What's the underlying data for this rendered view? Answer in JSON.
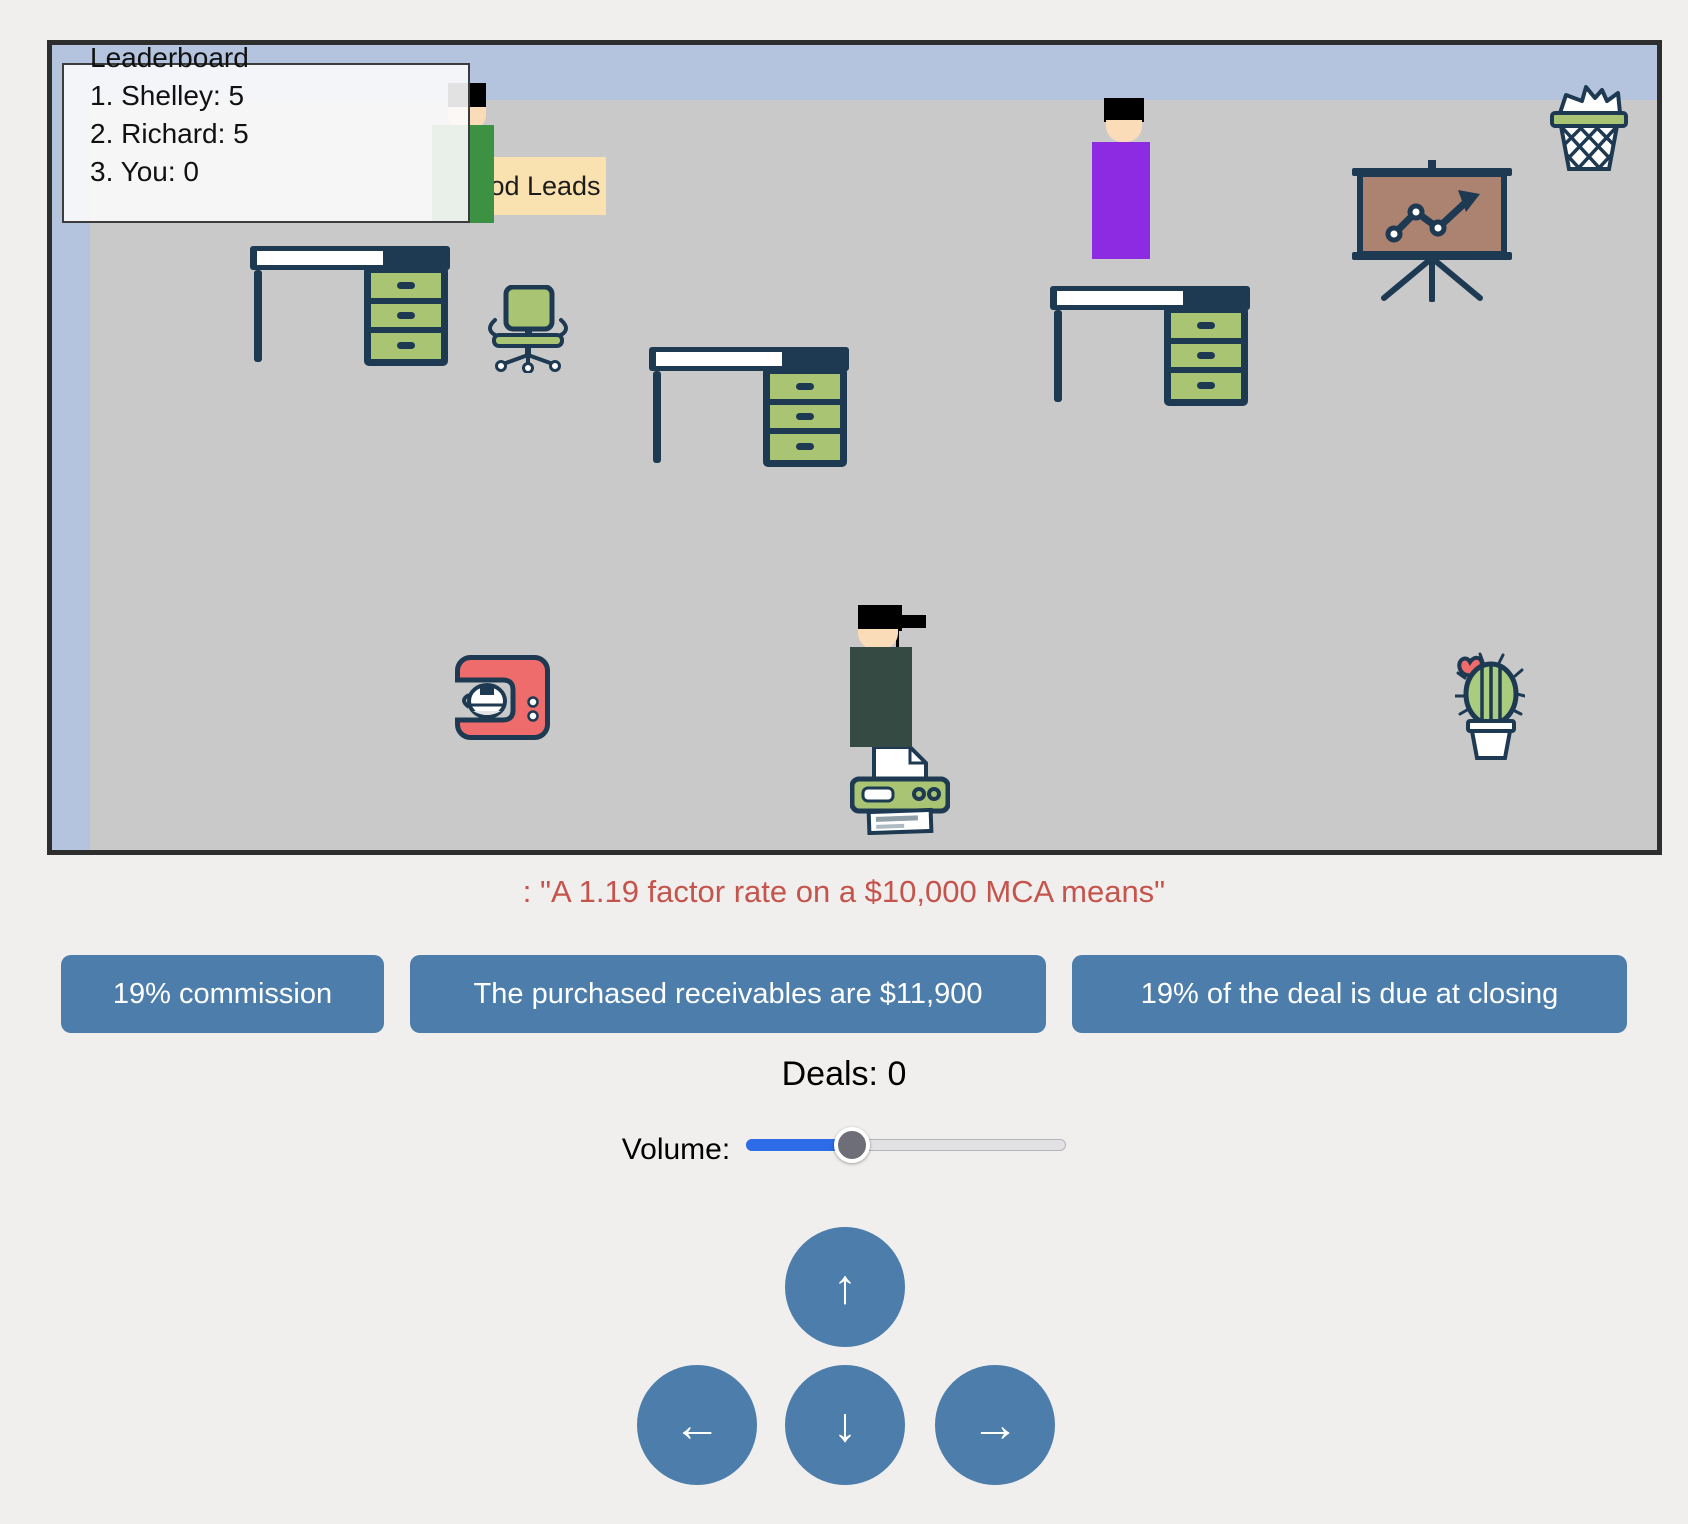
{
  "colors": {
    "wall_blue": "#b4c3de",
    "floor_gray": "#c9c9c9",
    "outline_navy": "#1e3a52",
    "furniture_green": "#a9c573",
    "button_blue": "#4d7dab",
    "prompt_red": "#c5544c",
    "lead_label_bg": "#fae2b0",
    "character_green": "#3c9142",
    "character_purple": "#8c2be2",
    "character_dark": "#364a44",
    "skin": "#fbdcb8",
    "coffee_red": "#ee6c6c",
    "board_brown": "#ac8270",
    "slider_fill_blue": "#2e6be6"
  },
  "game": {
    "leaderboard": {
      "title": "Leaderboard",
      "entries": [
        "1. Shelley: 5",
        "2. Richard: 5",
        "3. You: 0"
      ]
    },
    "lead_label": "Good Leads",
    "icons": [
      "desk-icon",
      "office-chair-icon",
      "presentation-board-icon",
      "trash-can-icon",
      "coffee-machine-icon",
      "printer-icon",
      "cactus-icon"
    ]
  },
  "quiz": {
    "prompt": ": \"A 1.19 factor rate on a $10,000 MCA means\"",
    "answers": [
      "19% commission",
      "The purchased receivables are $11,900",
      "19% of the deal is due at closing"
    ]
  },
  "hud": {
    "deals_text": "Deals: 0",
    "volume_label": "Volume:",
    "volume_percent": 33
  },
  "controls": {
    "up_arrow": "↑",
    "down_arrow": "↓",
    "left_arrow": "←",
    "right_arrow": "→"
  }
}
